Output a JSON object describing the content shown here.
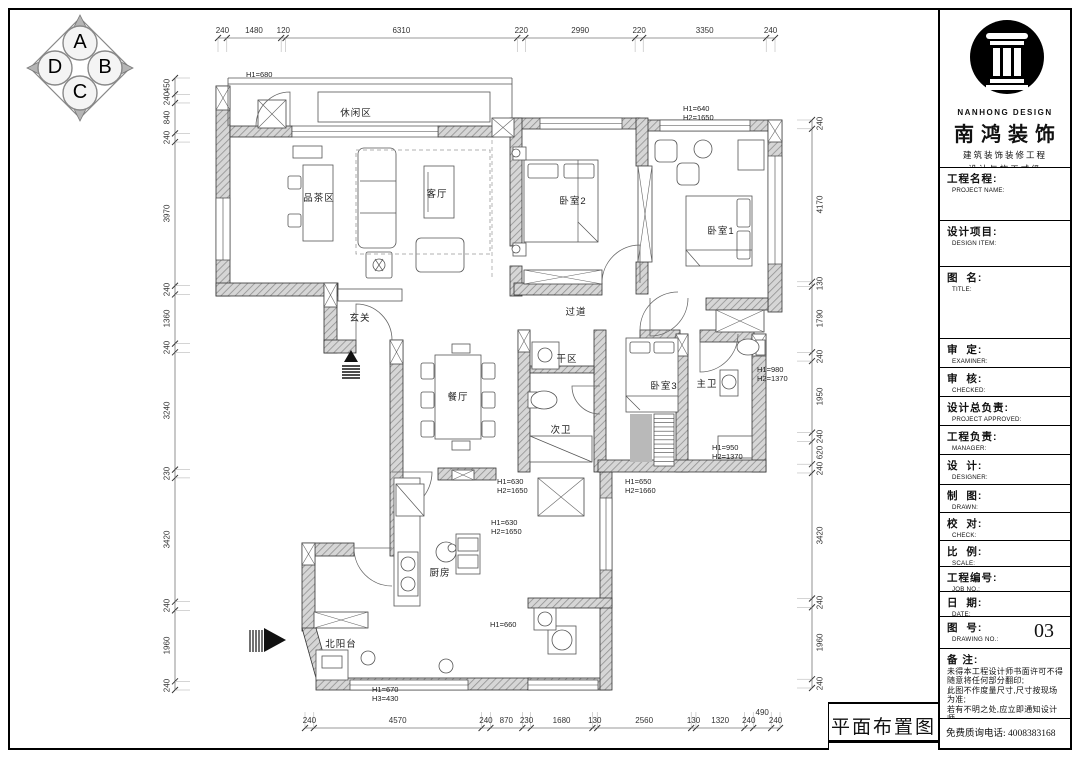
{
  "drawing_title": "平面布置图",
  "compass": {
    "a": "A",
    "b": "B",
    "c": "C",
    "d": "D"
  },
  "dimensions": {
    "top": {
      "values": [
        240,
        1480,
        120,
        6310,
        220,
        2990,
        220,
        3350,
        240
      ]
    },
    "bottom": {
      "values": [
        240,
        4570,
        240,
        870,
        230,
        1680,
        130,
        2560,
        130,
        1320,
        240,
        490,
        240
      ]
    },
    "left": {
      "values": [
        450,
        240,
        840,
        240,
        3970,
        240,
        1360,
        240,
        3240,
        230,
        3420,
        240,
        1960,
        240
      ]
    },
    "right": {
      "values": [
        240,
        4170,
        130,
        1790,
        240,
        1950,
        240,
        620,
        240,
        3420,
        240,
        1960,
        240
      ]
    }
  },
  "rooms": [
    {
      "label": "休闲区",
      "x": 356,
      "y": 112
    },
    {
      "label": "品茶区",
      "x": 319,
      "y": 197
    },
    {
      "label": "客厅",
      "x": 437,
      "y": 193
    },
    {
      "label": "卧室2",
      "x": 573,
      "y": 200
    },
    {
      "label": "卧室1",
      "x": 721,
      "y": 230
    },
    {
      "label": "玄关",
      "x": 360,
      "y": 317
    },
    {
      "label": "过道",
      "x": 576,
      "y": 311
    },
    {
      "label": "餐厅",
      "x": 458,
      "y": 396
    },
    {
      "label": "干区",
      "x": 567,
      "y": 358
    },
    {
      "label": "次卫",
      "x": 561,
      "y": 429
    },
    {
      "label": "卧室3",
      "x": 664,
      "y": 385
    },
    {
      "label": "主卫",
      "x": 707,
      "y": 383
    },
    {
      "label": "厨房",
      "x": 440,
      "y": 572
    },
    {
      "label": "北阳台",
      "x": 341,
      "y": 643
    }
  ],
  "annotations": [
    {
      "lines": [
        "H1=680"
      ],
      "x": 246,
      "y": 70
    },
    {
      "lines": [
        "H1=640",
        "H2=1650"
      ],
      "x": 683,
      "y": 104
    },
    {
      "lines": [
        "H1=980",
        "H2=1370"
      ],
      "x": 757,
      "y": 365
    },
    {
      "lines": [
        "H1=950",
        "H2=1370"
      ],
      "x": 712,
      "y": 443
    },
    {
      "lines": [
        "H1=630",
        "H2=1650"
      ],
      "x": 497,
      "y": 477
    },
    {
      "lines": [
        "H1=630",
        "H2=1650"
      ],
      "x": 491,
      "y": 518
    },
    {
      "lines": [
        "H1=650",
        "H2=1660"
      ],
      "x": 625,
      "y": 477
    },
    {
      "lines": [
        "H1=660"
      ],
      "x": 490,
      "y": 620
    },
    {
      "lines": [
        "H1=670",
        "H3=430"
      ],
      "x": 372,
      "y": 685
    }
  ],
  "title_block": {
    "brand_en": "NANHONG DESIGN",
    "brand_cn": "南鸿装饰",
    "sub1": "建筑装饰装修工程",
    "sub2": "设计与施工贰级",
    "cert_no": "#NO:X233021396",
    "fields": [
      {
        "cn": "工程名程:",
        "en": "PROJECT NAME:",
        "h": 53
      },
      {
        "cn": "设计项目:",
        "en": "DESIGN ITEM:",
        "h": 46
      },
      {
        "cn": "图  名:",
        "en": "TITLE:",
        "h": 72
      },
      {
        "cn": "审  定:",
        "en": "EXAMINER:",
        "h": 29
      },
      {
        "cn": "审  核:",
        "en": "CHECKED:",
        "h": 29
      },
      {
        "cn": "设计总负责:",
        "en": "PROJECT APPROVED:",
        "h": 29
      },
      {
        "cn": "工程负责:",
        "en": "MANAGER:",
        "h": 29
      },
      {
        "cn": "设  计:",
        "en": "DESIGNER:",
        "h": 30
      },
      {
        "cn": "制  图:",
        "en": "DRAWN:",
        "h": 28
      },
      {
        "cn": "校  对:",
        "en": "CHECK:",
        "h": 28
      },
      {
        "cn": "比  例:",
        "en": "SCALE:",
        "h": 26
      },
      {
        "cn": "工程编号:",
        "en": "JOB NO.:",
        "h": 25
      },
      {
        "cn": "日  期:",
        "en": "DATE:",
        "h": 25
      },
      {
        "cn": "图  号:",
        "en": "DRAWING NO.:",
        "h": 32,
        "value": "03"
      }
    ],
    "notes_title": "备 注:",
    "notes": [
      "未得本工程设计师书面许可不得",
      "随意将任何部分翻印;",
      "此图不作度量尺寸,尺寸按现场",
      "为准;",
      "若有不明之处,应立即通知设计",
      "师。"
    ],
    "notes_small": "本设计解释权归设计师所有。",
    "phone": "免费质询电话: 4008383168"
  }
}
